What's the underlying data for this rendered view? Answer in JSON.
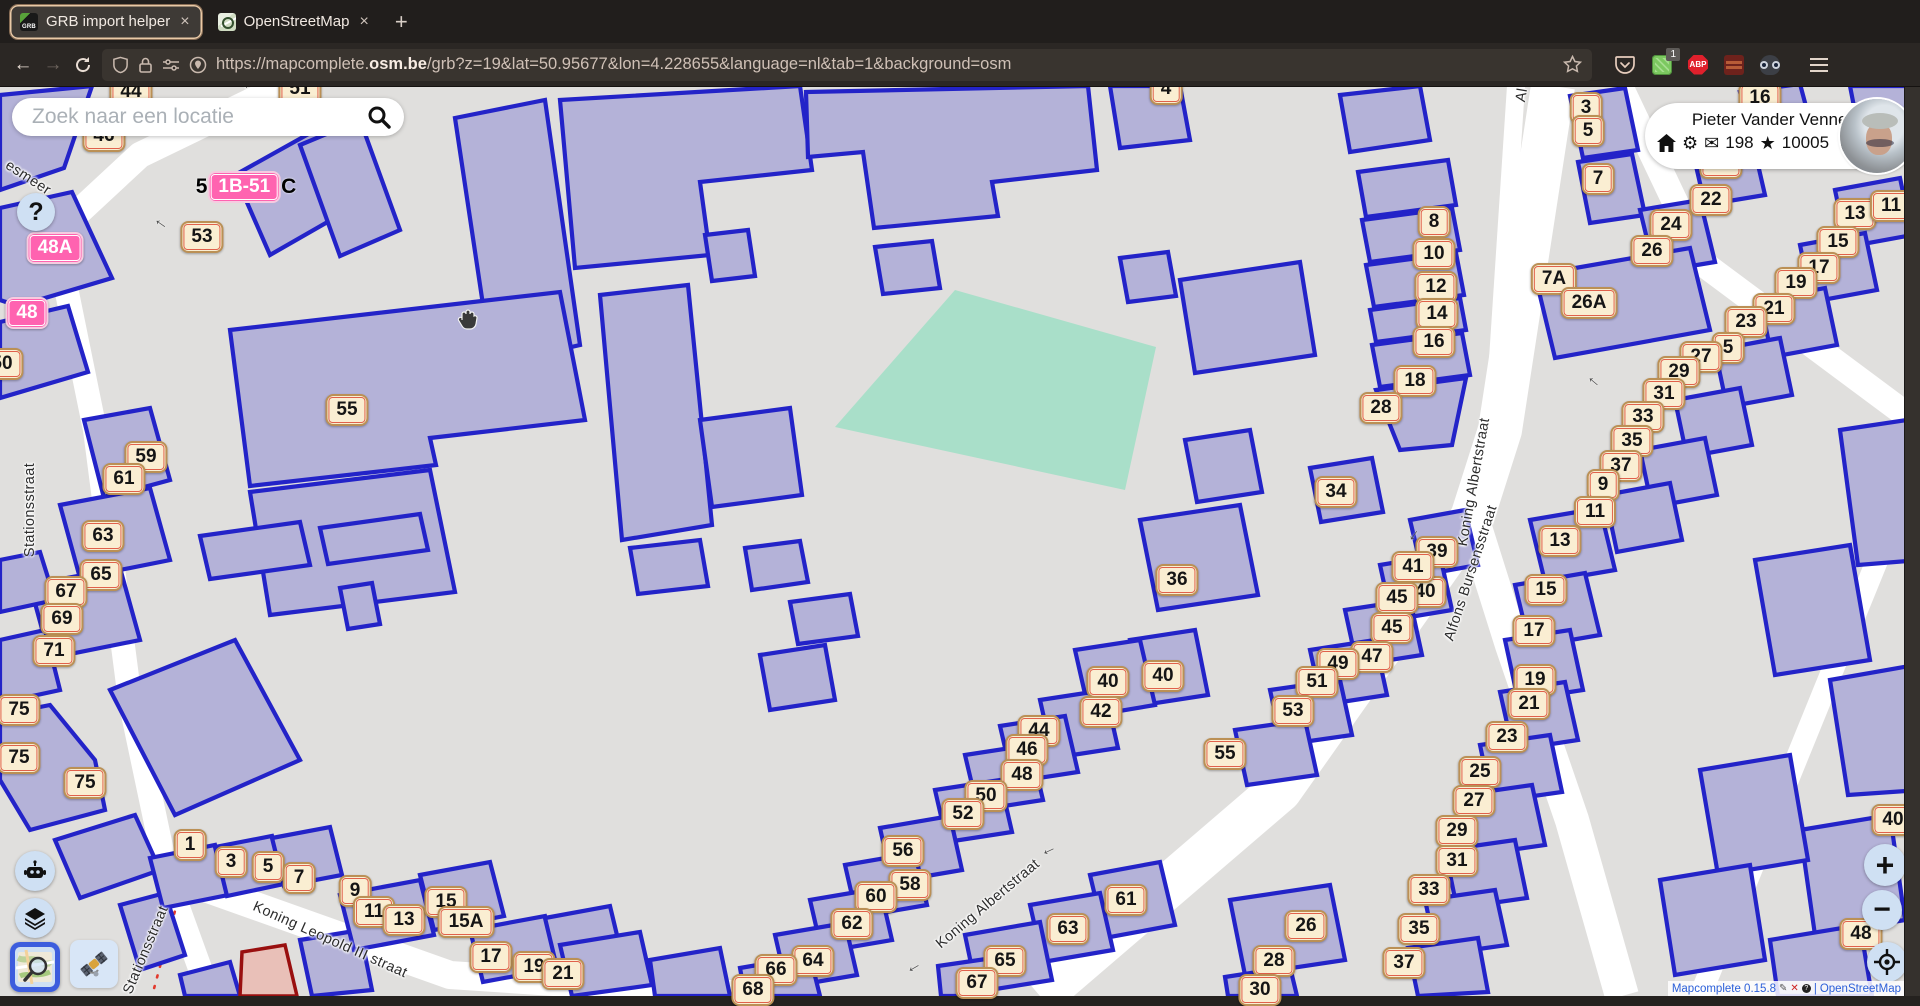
{
  "browser": {
    "tabs": [
      {
        "label": "GRB import helper"
      },
      {
        "label": "OpenStreetMap"
      }
    ],
    "close_label": "×",
    "new_tab_label": "+",
    "nav": {
      "back": "←",
      "forward": "→"
    },
    "url": {
      "prefix": "https://mapcomplete.",
      "domain": "osm.be",
      "path": "/grb?z=19&lat=50.95677&lon=4.228655&language=nl&tab=1&background=osm"
    },
    "ext_badge": "1",
    "abp_label": "ABP"
  },
  "search": {
    "placeholder": "Zoek naar een locatie"
  },
  "help": {
    "label": "?"
  },
  "user": {
    "name": "Pieter Vander Vennet",
    "messages": "198",
    "changesets": "10005",
    "gear": "⚙",
    "envelope": "✉",
    "star": "★"
  },
  "zoomctl": {
    "zoom_in": "+",
    "zoom_out": "−"
  },
  "attribution": {
    "app": "Mapcomplete 0.15.8",
    "pencil": "✎",
    "x": "✕",
    "c": "?",
    "sep": "|",
    "osm": "OpenStreetMap"
  },
  "colors": {
    "building_fill": "#b4b2d8",
    "building_stroke": "#2323c8",
    "map_bg": "#e0dfdd",
    "road": "#ffffff",
    "field_green": "#a9dfc9",
    "badge_bg": "#faeed2",
    "badge_border": "#bb9055",
    "badge_inner_border": "#e0614b",
    "pink_badge": "#ff63b0",
    "accent_blue": "#3d5ddd",
    "import_fill": "#e9c0b8",
    "import_stroke": "#990f0f"
  },
  "map": {
    "badges": [
      {
        "t": "44",
        "x": 131,
        "y": 92
      },
      {
        "t": "51",
        "x": 300,
        "y": 89
      },
      {
        "t": "4",
        "x": 1166,
        "y": 89
      },
      {
        "t": "46",
        "x": 104,
        "y": 136
      },
      {
        "t": "53",
        "x": 202,
        "y": 237
      },
      {
        "t": "50",
        "x": 2,
        "y": 364
      },
      {
        "t": "55",
        "x": 347,
        "y": 410
      },
      {
        "t": "59",
        "x": 146,
        "y": 457
      },
      {
        "t": "61",
        "x": 124,
        "y": 479
      },
      {
        "t": "63",
        "x": 103,
        "y": 536
      },
      {
        "t": "65",
        "x": 101,
        "y": 575
      },
      {
        "t": "67",
        "x": 66,
        "y": 592
      },
      {
        "t": "69",
        "x": 62,
        "y": 619
      },
      {
        "t": "71",
        "x": 54,
        "y": 651
      },
      {
        "t": "75",
        "x": 19,
        "y": 710
      },
      {
        "t": "75",
        "x": 19,
        "y": 758
      },
      {
        "t": "75",
        "x": 85,
        "y": 783
      },
      {
        "t": "8",
        "x": 1434,
        "y": 222
      },
      {
        "t": "10",
        "x": 1434,
        "y": 254
      },
      {
        "t": "12",
        "x": 1436,
        "y": 287
      },
      {
        "t": "14",
        "x": 1437,
        "y": 314
      },
      {
        "t": "16",
        "x": 1434,
        "y": 342
      },
      {
        "t": "18",
        "x": 1415,
        "y": 381
      },
      {
        "t": "28",
        "x": 1381,
        "y": 408
      },
      {
        "t": "34",
        "x": 1336,
        "y": 492
      },
      {
        "t": "36",
        "x": 1177,
        "y": 580
      },
      {
        "t": "40",
        "x": 1425,
        "y": 592
      },
      {
        "t": "39",
        "x": 1437,
        "y": 552
      },
      {
        "t": "41",
        "x": 1413,
        "y": 567
      },
      {
        "t": "45",
        "x": 1397,
        "y": 598
      },
      {
        "t": "45",
        "x": 1392,
        "y": 628
      },
      {
        "t": "47",
        "x": 1372,
        "y": 657
      },
      {
        "t": "49",
        "x": 1338,
        "y": 664
      },
      {
        "t": "51",
        "x": 1317,
        "y": 682
      },
      {
        "t": "53",
        "x": 1293,
        "y": 711
      },
      {
        "t": "55",
        "x": 1225,
        "y": 754
      },
      {
        "t": "40",
        "x": 1163,
        "y": 676
      },
      {
        "t": "40",
        "x": 1108,
        "y": 682
      },
      {
        "t": "42",
        "x": 1101,
        "y": 712
      },
      {
        "t": "44",
        "x": 1039,
        "y": 731
      },
      {
        "t": "46",
        "x": 1027,
        "y": 750
      },
      {
        "t": "48",
        "x": 1022,
        "y": 775
      },
      {
        "t": "50",
        "x": 986,
        "y": 796
      },
      {
        "t": "52",
        "x": 963,
        "y": 814
      },
      {
        "t": "56",
        "x": 903,
        "y": 851
      },
      {
        "t": "58",
        "x": 910,
        "y": 885
      },
      {
        "t": "60",
        "x": 876,
        "y": 897
      },
      {
        "t": "62",
        "x": 852,
        "y": 924
      },
      {
        "t": "64",
        "x": 813,
        "y": 961
      },
      {
        "t": "66",
        "x": 776,
        "y": 970
      },
      {
        "t": "68",
        "x": 753,
        "y": 990
      },
      {
        "t": "65",
        "x": 1005,
        "y": 961
      },
      {
        "t": "67",
        "x": 977,
        "y": 983
      },
      {
        "t": "63",
        "x": 1068,
        "y": 929
      },
      {
        "t": "61",
        "x": 1126,
        "y": 900
      },
      {
        "t": "16",
        "x": 1760,
        "y": 98
      },
      {
        "t": "3",
        "x": 1586,
        "y": 108
      },
      {
        "t": "5",
        "x": 1588,
        "y": 131
      },
      {
        "t": "20",
        "x": 1721,
        "y": 163
      },
      {
        "t": "7",
        "x": 1598,
        "y": 179
      },
      {
        "t": "22",
        "x": 1711,
        "y": 200
      },
      {
        "t": "24",
        "x": 1671,
        "y": 225
      },
      {
        "t": "26",
        "x": 1652,
        "y": 251
      },
      {
        "t": "7A",
        "x": 1554,
        "y": 279
      },
      {
        "t": "26A",
        "x": 1589,
        "y": 303
      },
      {
        "t": "13",
        "x": 1855,
        "y": 214
      },
      {
        "t": "11",
        "x": 1891,
        "y": 206
      },
      {
        "t": "15",
        "x": 1838,
        "y": 242
      },
      {
        "t": "17",
        "x": 1819,
        "y": 268
      },
      {
        "t": "19",
        "x": 1796,
        "y": 283
      },
      {
        "t": "21",
        "x": 1774,
        "y": 309
      },
      {
        "t": "23",
        "x": 1746,
        "y": 322
      },
      {
        "t": "5",
        "x": 1728,
        "y": 348
      },
      {
        "t": "27",
        "x": 1701,
        "y": 357
      },
      {
        "t": "29",
        "x": 1679,
        "y": 372
      },
      {
        "t": "31",
        "x": 1664,
        "y": 394
      },
      {
        "t": "33",
        "x": 1643,
        "y": 417
      },
      {
        "t": "35",
        "x": 1632,
        "y": 441
      },
      {
        "t": "37",
        "x": 1621,
        "y": 466
      },
      {
        "t": "9",
        "x": 1603,
        "y": 485
      },
      {
        "t": "11",
        "x": 1595,
        "y": 512
      },
      {
        "t": "13",
        "x": 1560,
        "y": 541
      },
      {
        "t": "15",
        "x": 1546,
        "y": 590
      },
      {
        "t": "17",
        "x": 1534,
        "y": 631
      },
      {
        "t": "19",
        "x": 1535,
        "y": 680
      },
      {
        "t": "21",
        "x": 1529,
        "y": 704
      },
      {
        "t": "23",
        "x": 1507,
        "y": 737
      },
      {
        "t": "25",
        "x": 1480,
        "y": 772
      },
      {
        "t": "27",
        "x": 1474,
        "y": 801
      },
      {
        "t": "29",
        "x": 1457,
        "y": 831
      },
      {
        "t": "31",
        "x": 1457,
        "y": 861
      },
      {
        "t": "33",
        "x": 1429,
        "y": 890
      },
      {
        "t": "35",
        "x": 1419,
        "y": 929
      },
      {
        "t": "37",
        "x": 1404,
        "y": 963
      },
      {
        "t": "26",
        "x": 1306,
        "y": 926
      },
      {
        "t": "28",
        "x": 1274,
        "y": 961
      },
      {
        "t": "30",
        "x": 1260,
        "y": 990
      },
      {
        "t": "40",
        "x": 1893,
        "y": 820
      },
      {
        "t": "48",
        "x": 1861,
        "y": 934
      },
      {
        "t": "1",
        "x": 190,
        "y": 845
      },
      {
        "t": "3",
        "x": 231,
        "y": 862
      },
      {
        "t": "5",
        "x": 268,
        "y": 867
      },
      {
        "t": "7",
        "x": 299,
        "y": 878
      },
      {
        "t": "9",
        "x": 355,
        "y": 891
      },
      {
        "t": "11",
        "x": 374,
        "y": 912
      },
      {
        "t": "13",
        "x": 404,
        "y": 920
      },
      {
        "t": "15",
        "x": 446,
        "y": 902
      },
      {
        "t": "15A",
        "x": 466,
        "y": 922
      },
      {
        "t": "17",
        "x": 491,
        "y": 957
      },
      {
        "t": "19",
        "x": 534,
        "y": 967
      },
      {
        "t": "21",
        "x": 563,
        "y": 974
      },
      {
        "t": "48A",
        "x": 55,
        "y": 248,
        "v": "pink"
      },
      {
        "t": "48",
        "x": 27,
        "y": 313,
        "v": "pink"
      },
      {
        "pre": "5",
        "t": "1B-51",
        "post": "C",
        "x": 246,
        "y": 187,
        "v": "pink"
      }
    ],
    "street_labels": [
      {
        "text": "esmeer",
        "x": 28,
        "y": 178,
        "rot": 33
      },
      {
        "text": "St",
        "x": 247,
        "y": 80,
        "rot": 65
      },
      {
        "text": "Stationsstraat",
        "x": 30,
        "y": 510,
        "rot": -90
      },
      {
        "text": "Stationsstraat",
        "x": 146,
        "y": 950,
        "rot": -67
      },
      {
        "text": "Koning Leopold III straat",
        "x": 330,
        "y": 940,
        "rot": 24
      },
      {
        "text": "Koning Albertstraat",
        "x": 1474,
        "y": 482,
        "rot": -80
      },
      {
        "text": "Koning Albertstraat",
        "x": 988,
        "y": 904,
        "rot": -40
      },
      {
        "text": "Alfons Bursensstraat",
        "x": 1471,
        "y": 573,
        "rot": -72
      },
      {
        "text": "Al",
        "x": 1522,
        "y": 95,
        "rot": -80
      }
    ],
    "arrows": [
      {
        "x": 1048,
        "y": 849,
        "r": -25
      },
      {
        "x": 913,
        "y": 966,
        "r": -30
      },
      {
        "x": 1412,
        "y": 534,
        "r": -55
      },
      {
        "x": 1595,
        "y": 380,
        "r": 40
      },
      {
        "x": 162,
        "y": 222,
        "r": 35
      }
    ]
  }
}
